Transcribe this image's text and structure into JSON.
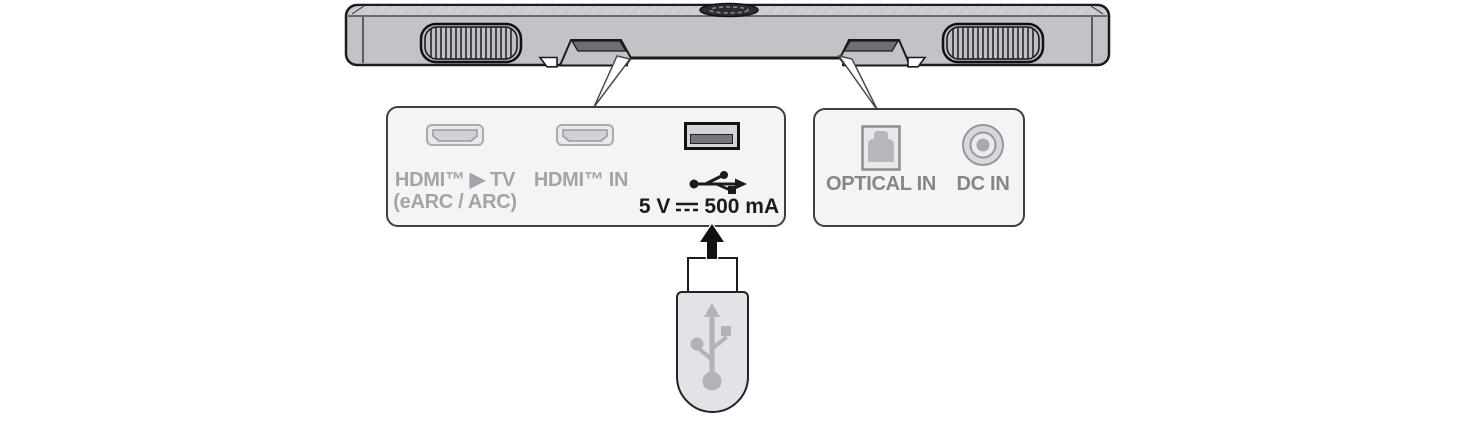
{
  "diagram": {
    "title": "Soundbar rear connections diagram",
    "soundbar": {
      "part": "soundbar-bottom-view",
      "features": [
        "left-speaker-grille",
        "top-mount-oval",
        "right-speaker-grille",
        "left-cable-notch",
        "right-cable-notch"
      ]
    },
    "left_panel": {
      "ports": [
        {
          "id": "hdmi-out-tv",
          "icon": "hdmi-port-icon",
          "label_line1": "HDMI™ ▶ TV",
          "label_line2": "(eARC / ARC)"
        },
        {
          "id": "hdmi-in",
          "icon": "hdmi-port-icon",
          "label_line1": "HDMI™ IN"
        },
        {
          "id": "usb",
          "icon": "usb-port-icon",
          "symbol": "usb-trident-icon",
          "rating_prefix": "5 V",
          "rating_symbol": "dc-symbol-icon",
          "rating_suffix": "500 mA"
        }
      ]
    },
    "right_panel": {
      "ports": [
        {
          "id": "optical-in",
          "icon": "optical-port-icon",
          "label": "OPTICAL IN"
        },
        {
          "id": "dc-in",
          "icon": "dc-jack-icon",
          "label": "DC IN"
        }
      ]
    },
    "usb_drive": {
      "id": "usb-flash-drive",
      "symbol": "usb-trident-icon",
      "insert_direction": "up"
    }
  },
  "colors": {
    "background": "#ffffff",
    "bar_body": "#c2c3c7",
    "bar_top_strip": "#cdced2",
    "outline": "#1b1b1d",
    "panel_fill": "#f4f4f6",
    "panel_border": "#3f3f43",
    "label_gray_light": "#a4a4a8",
    "label_gray_dark": "#85868a",
    "rating_text": "#1b1b1d",
    "drive_body": "#e3e3e7",
    "trident_gray": "#b3b3b7"
  }
}
